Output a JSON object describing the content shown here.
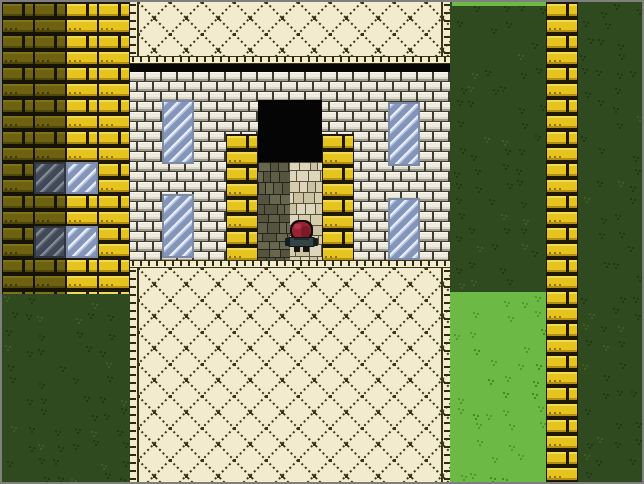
{
  "scene": {
    "width": 640,
    "height": 480,
    "tile_size": 32,
    "frame_color": "#7F7F7F",
    "palette": {
      "black": "#060606",
      "grass": {
        "dark_bg": "#2F4A1E",
        "dark_tuft": "#22380F",
        "dark_tuft_light": "#3E5D26",
        "light_bg": "#6CB945",
        "light_tuft": "#4E9832",
        "light_tuft_dark": "#3F8A28"
      },
      "brick": {
        "yellow": {
          "mortar": "#1E1905",
          "face": "#E5C41F",
          "light": "#F2DA52",
          "dark": "#B3910E",
          "dot": "#8F710B"
        },
        "olive": {
          "mortar": "#171303",
          "face": "#6C6212",
          "light": "#7E7218",
          "dark": "#4E460B",
          "dot": "#3F3908"
        },
        "white": {
          "mortar": "#3C3C33",
          "face": "#EFECDF",
          "light": "#FBF9F1",
          "inner": "#DCD9CA",
          "under": "#9C9B8E"
        }
      },
      "diamond": {
        "bg": "#F2EBCE",
        "line": "#3B3517",
        "dash": "#2F2A12"
      },
      "window": {
        "light": {
          "base": "#B6C4E4",
          "band": "#8396BA",
          "streak": "#EDF1FA",
          "border": "#7C8AA6"
        },
        "shadow": {
          "base": "#59606C",
          "band": "#424956",
          "streak": "#848E9D",
          "border": "#30353E"
        }
      },
      "cobble": {
        "light": {
          "line": "#57503A",
          "fills": [
            "#D6CDAF",
            "#CBC2A4",
            "#DED6BC"
          ]
        },
        "dark": {
          "line": "#26251A",
          "fills": [
            "#5E5D48",
            "#555440",
            "#67664F"
          ]
        }
      }
    },
    "regions": [
      {
        "name": "grass-left",
        "type": "grass",
        "variant": "dark",
        "rect": [
          0,
          292,
          128,
          188
        ]
      },
      {
        "name": "wall-left-shaded",
        "type": "brick",
        "variant": "olive",
        "rect": [
          0,
          0,
          64,
          292
        ]
      },
      {
        "name": "wall-left-lit",
        "type": "brick",
        "variant": "yellow",
        "rect": [
          64,
          0,
          64,
          292
        ]
      },
      {
        "name": "left-window-1-shaded",
        "type": "window",
        "variant": "shadow",
        "rect": [
          32,
          160,
          32,
          32
        ]
      },
      {
        "name": "left-window-1-lit",
        "type": "window",
        "variant": "light",
        "rect": [
          64,
          160,
          32,
          32
        ]
      },
      {
        "name": "left-window-2-shaded",
        "type": "window",
        "variant": "shadow",
        "rect": [
          32,
          224,
          32,
          32
        ]
      },
      {
        "name": "left-window-2-lit",
        "type": "window",
        "variant": "light",
        "rect": [
          64,
          224,
          32,
          32
        ]
      },
      {
        "name": "plaza-top",
        "type": "diamond",
        "edges": [
          "left",
          "right"
        ],
        "rect": [
          128,
          0,
          320,
          54
        ]
      },
      {
        "name": "plaza-top-edge",
        "type": "dash-h",
        "rect": [
          128,
          54,
          320,
          8
        ]
      },
      {
        "name": "roof-shadow-band",
        "type": "solid",
        "color": "#060606",
        "rect": [
          128,
          62,
          320,
          8
        ]
      },
      {
        "name": "building-wall",
        "type": "brick",
        "variant": "white",
        "rect": [
          128,
          70,
          320,
          188
        ]
      },
      {
        "name": "window-left-upper",
        "type": "window",
        "variant": "light",
        "rect": [
          160,
          98,
          32,
          64
        ]
      },
      {
        "name": "window-left-lower",
        "type": "window",
        "variant": "light",
        "rect": [
          160,
          192,
          32,
          64
        ]
      },
      {
        "name": "window-right-upper",
        "type": "window",
        "variant": "light",
        "rect": [
          386,
          100,
          32,
          64
        ]
      },
      {
        "name": "window-right-lower",
        "type": "window",
        "variant": "light",
        "rect": [
          386,
          196,
          32,
          62
        ]
      },
      {
        "name": "doorway-opening",
        "type": "solid",
        "color": "#050505",
        "rect": [
          256,
          98,
          64,
          62
        ]
      },
      {
        "name": "door-pillar-left",
        "type": "brick",
        "variant": "yellow",
        "rect": [
          224,
          132,
          32,
          126
        ]
      },
      {
        "name": "door-pillar-right",
        "type": "brick",
        "variant": "yellow",
        "rect": [
          320,
          132,
          32,
          126
        ]
      },
      {
        "name": "door-path-shaded",
        "type": "cobble",
        "variant": "dark",
        "rect": [
          256,
          160,
          32,
          98
        ]
      },
      {
        "name": "door-path-lit",
        "type": "cobble",
        "variant": "light",
        "rect": [
          288,
          160,
          32,
          98
        ]
      },
      {
        "name": "plaza-bottom-edge",
        "type": "dash-h",
        "rect": [
          128,
          258,
          320,
          8
        ]
      },
      {
        "name": "plaza-bottom",
        "type": "diamond",
        "edges": [
          "left",
          "right"
        ],
        "rect": [
          128,
          266,
          320,
          214
        ]
      },
      {
        "name": "grass-right-dark",
        "type": "grass",
        "variant": "dark",
        "rect": [
          448,
          0,
          96,
          290
        ]
      },
      {
        "name": "grass-right-top-lit",
        "type": "solid",
        "color": "#6CB945",
        "rect": [
          450,
          0,
          94,
          4
        ]
      },
      {
        "name": "grass-right-light",
        "type": "grass",
        "variant": "light",
        "rect": [
          448,
          290,
          96,
          190
        ]
      },
      {
        "name": "wall-right-column",
        "type": "brick",
        "variant": "yellow",
        "rect": [
          544,
          0,
          32,
          480
        ]
      },
      {
        "name": "grass-far-right",
        "type": "grass",
        "variant": "dark",
        "rect": [
          576,
          0,
          64,
          480
        ]
      }
    ],
    "player": {
      "name": "player-character",
      "parts": [
        {
          "part": "head-outline",
          "rect": [
            288,
            218,
            23,
            21
          ],
          "rx": 9,
          "fill": "#140A0D"
        },
        {
          "part": "head-cap",
          "rect": [
            290,
            220,
            19,
            17
          ],
          "rx": 8,
          "fill": "#9B2231"
        },
        {
          "part": "head-shade",
          "rect": [
            299,
            224,
            9,
            12
          ],
          "rx": 4,
          "fill": "#7A1A27"
        },
        {
          "part": "head-highlight",
          "rect": [
            292,
            222,
            7,
            5
          ],
          "rx": 2,
          "fill": "#B23648"
        },
        {
          "part": "body-outline",
          "rect": [
            286,
            235,
            27,
            10
          ],
          "rx": 2,
          "fill": "#0E1416"
        },
        {
          "part": "body",
          "rect": [
            288,
            236,
            23,
            8
          ],
          "rx": 0,
          "fill": "#334447"
        },
        {
          "part": "collar",
          "rect": [
            292,
            236,
            15,
            2
          ],
          "rx": 0,
          "fill": "#1F2D30"
        },
        {
          "part": "arm-left",
          "rect": [
            283,
            236,
            5,
            8
          ],
          "rx": 1,
          "fill": "#141D1F"
        },
        {
          "part": "arm-right",
          "rect": [
            311,
            236,
            5,
            8
          ],
          "rx": 1,
          "fill": "#141D1F"
        },
        {
          "part": "leg-left",
          "rect": [
            292,
            244,
            6,
            6
          ],
          "rx": 0,
          "fill": "#1A1210"
        },
        {
          "part": "leg-right",
          "rect": [
            301,
            244,
            6,
            6
          ],
          "rx": 0,
          "fill": "#1A1210"
        }
      ]
    }
  }
}
